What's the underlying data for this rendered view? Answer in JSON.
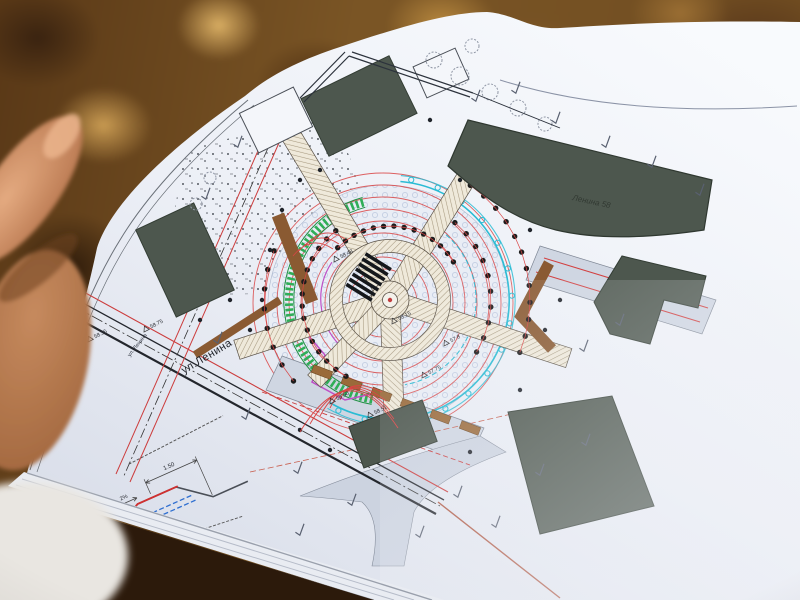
{
  "photo": {
    "background_base_color": "#6e4b20",
    "paper_color": "#eef1f7",
    "hand_skin_color": "#c08663"
  },
  "plan": {
    "street_label_large": "ул.Ленина",
    "street_label_small": "ул. Ленина",
    "building_label": "Ленина 58",
    "elevations": [
      "58.75",
      "58.35",
      "58.15",
      "58.48",
      "58.50",
      "58.51",
      "57.8",
      "57.75",
      "58.76",
      "58.82"
    ],
    "section": {
      "width": "1.50",
      "slope": "2%"
    }
  },
  "colors": {
    "contour_red": "#d94545",
    "hedge_green": "#2fae57",
    "edging_cyan": "#2bbcd4",
    "path_brown": "#8a5a32",
    "accent_magenta": "#bf4fc6",
    "building_fill": "#4d574e",
    "road_fill": "#cfd6e2"
  }
}
